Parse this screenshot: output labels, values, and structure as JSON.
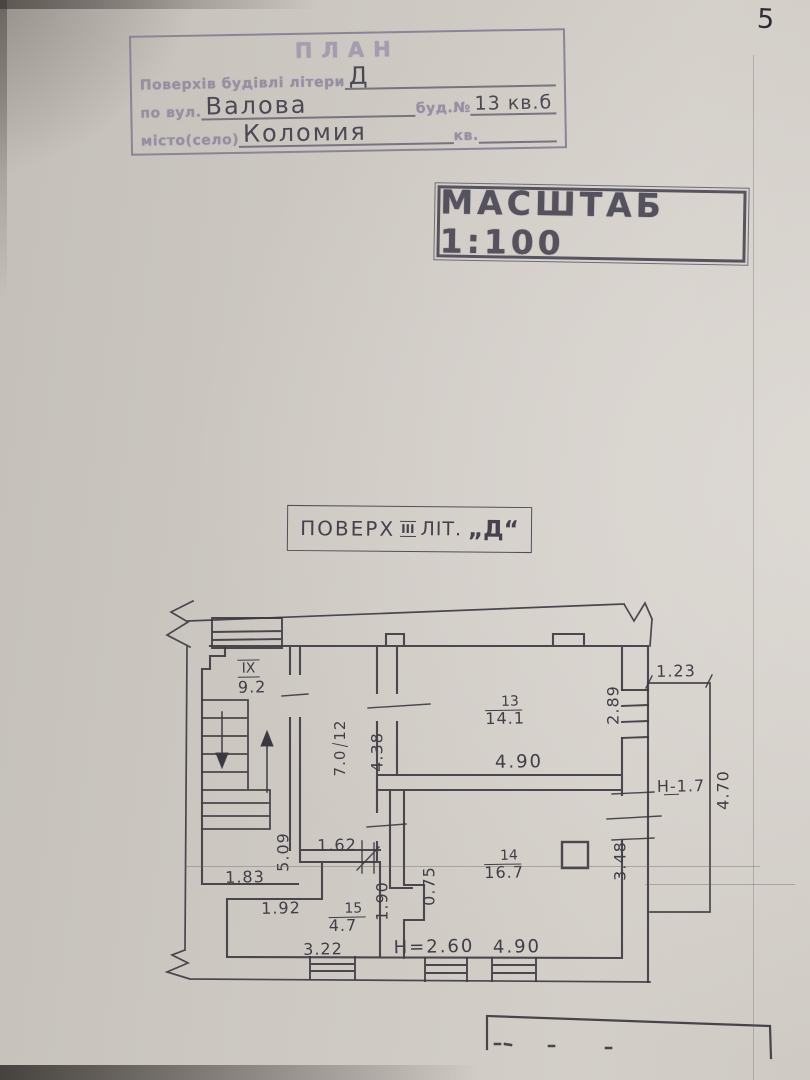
{
  "page": {
    "number": "5"
  },
  "header": {
    "title": "ПЛАН",
    "row1_label": "Поверхів будівлі літери",
    "row1_value": "Д",
    "row2_label": "по вул.",
    "row2_value": "Валова",
    "row2_label2": "буд.№",
    "row2_value2": "13 кв.б",
    "row3_label": "місто(село)",
    "row3_value": "Коломия",
    "row3_label2": "кв."
  },
  "scale_stamp": {
    "text": "МАСШТАБ 1:100"
  },
  "floor_title": {
    "word": "ПОВЕРХ",
    "number": "III",
    "lit": "ЛІТ.",
    "letter": "„Д“"
  },
  "plan": {
    "stair_label": {
      "num": "IX",
      "area": "9.2"
    },
    "room12": {
      "num": "12",
      "area": "7.0"
    },
    "room13": {
      "num": "13",
      "area": "14.1"
    },
    "room14": {
      "num": "14",
      "area": "16.7"
    },
    "room15": {
      "num": "15",
      "area": "4.7"
    },
    "dims": {
      "w438": "4.38",
      "w490_13": "4.90",
      "h289": "2.89",
      "w123": "1.23",
      "balc_h": "Н-1.7",
      "h470": "4.70",
      "h348": "3.48",
      "w162": "1.62",
      "h075": "0.75",
      "h190": "1.90",
      "w192": "1.92",
      "w183": "1.83",
      "h509": "5.09",
      "w322": "3.22",
      "ceil_h": "Н=2.60",
      "w490_14": "4.90"
    }
  }
}
